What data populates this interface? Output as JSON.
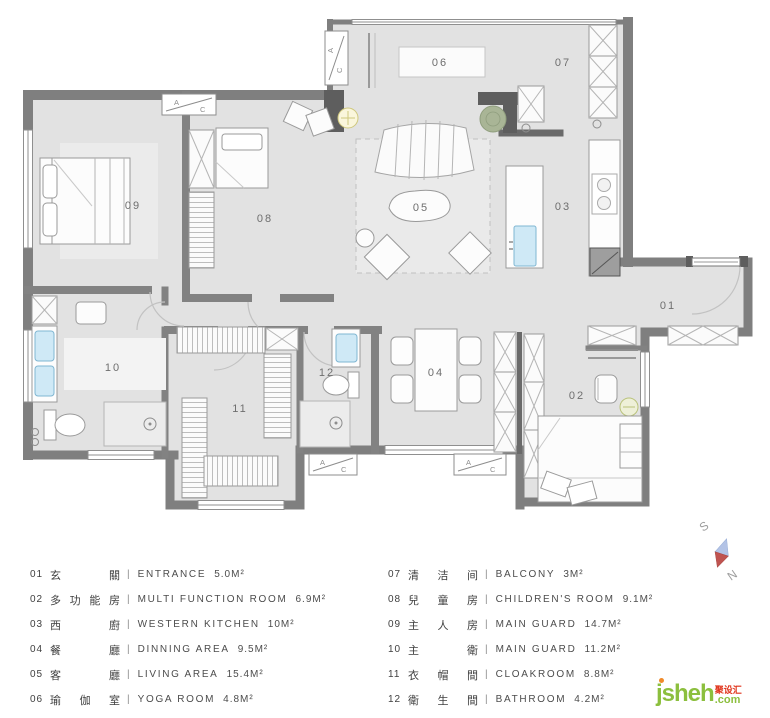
{
  "floorplan": {
    "room_numbers": [
      "01",
      "02",
      "03",
      "04",
      "05",
      "06",
      "07",
      "08",
      "09",
      "10",
      "11",
      "12"
    ],
    "ac": {
      "a": "A",
      "c": "C"
    }
  },
  "compass": {
    "south": "S",
    "north": "N"
  },
  "legend": {
    "sep": "|",
    "items": [
      {
        "num": "01",
        "cn": "玄關",
        "en": "ENTRANCE",
        "area": "5.0M²"
      },
      {
        "num": "02",
        "cn": "多功能房",
        "en": "MULTI FUNCTION ROOM",
        "area": "6.9M²"
      },
      {
        "num": "03",
        "cn": "西廚",
        "en": "WESTERN KITCHEN",
        "area": "10M²"
      },
      {
        "num": "04",
        "cn": "餐廳",
        "en": "DINNING AREA",
        "area": "9.5M²"
      },
      {
        "num": "05",
        "cn": "客廳",
        "en": "LIVING AREA",
        "area": "15.4M²"
      },
      {
        "num": "06",
        "cn": "瑜伽室",
        "en": "YOGA ROOM",
        "area": "4.8M²"
      },
      {
        "num": "07",
        "cn": "清洁间",
        "en": "BALCONY",
        "area": "3M²"
      },
      {
        "num": "08",
        "cn": "兒童房",
        "en": "CHILDREN'S ROOM",
        "area": "9.1M²"
      },
      {
        "num": "09",
        "cn": "主人房",
        "en": "MAIN GUARD",
        "area": "14.7M²"
      },
      {
        "num": "10",
        "cn": "主衛",
        "en": "MAIN GUARD",
        "area": "11.2M²"
      },
      {
        "num": "11",
        "cn": "衣帽間",
        "en": "CLOAKROOM",
        "area": "8.8M²"
      },
      {
        "num": "12",
        "cn": "衛生間",
        "en": "BATHROOM",
        "area": "4.2M²"
      }
    ]
  },
  "logo": {
    "main": "jsheh",
    "cn": "聚设汇",
    "com": ".com"
  },
  "colors": {
    "wall": "#828282",
    "wall_dark": "#5e5e5e",
    "floor": "#e2e2e2",
    "sink_blue": "#cfe9f6",
    "plant_green": "#a9b596",
    "logo_green": "#8cbf3e",
    "logo_red": "#e0331a",
    "compass_blue": "#b3c3e6",
    "compass_red": "#bf5350"
  }
}
